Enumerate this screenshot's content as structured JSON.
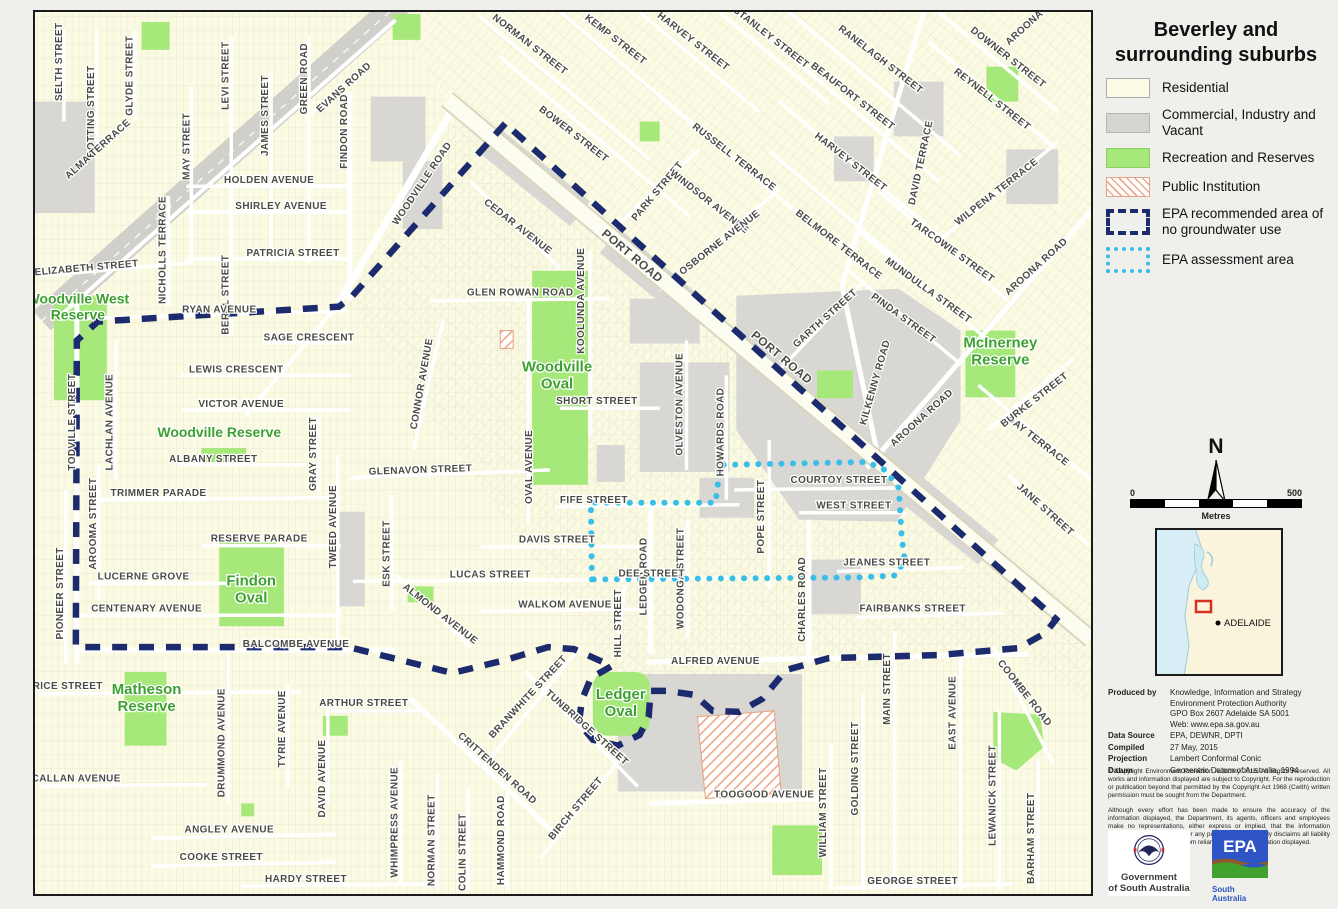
{
  "title": {
    "line1": "Beverley and",
    "line2": "surrounding suburbs"
  },
  "legend": {
    "items": [
      {
        "key": "residential",
        "label": "Residential"
      },
      {
        "key": "commercial",
        "label": "Commercial, Industry and Vacant"
      },
      {
        "key": "recreation",
        "label": "Recreation and Reserves"
      },
      {
        "key": "public",
        "label": "Public Institution"
      },
      {
        "key": "epa-recommended",
        "label": "EPA recommended area of no groundwater use"
      },
      {
        "key": "epa-assessment",
        "label": "EPA assessment area"
      }
    ]
  },
  "colors": {
    "residential": "#fcfbe3",
    "commercial": "#d6d5d1",
    "recreation": "#a7e87b",
    "public_hatch": "#eda98b",
    "epa_recommended": "#1b2b6e",
    "epa_assessment": "#38bfe8",
    "reserve_label": "#3da12f"
  },
  "compass": {
    "label": "N"
  },
  "scalebar": {
    "start": "0",
    "end": "500",
    "unit": "Metres"
  },
  "inset": {
    "city": "ADELAIDE"
  },
  "metadata": {
    "rows": [
      {
        "label": "Produced by",
        "lines": [
          "Knowledge, Information and Strategy",
          "Environment Protection Authority",
          "GPO Box 2607 Adelaide SA 5001",
          "Web: www.epa.sa.gov.au"
        ]
      },
      {
        "label": "Data Source",
        "lines": [
          "EPA, DEWNR, DPTI"
        ]
      },
      {
        "label": "Compiled",
        "lines": [
          "27 May, 2015"
        ]
      },
      {
        "label": "Projection",
        "lines": [
          "Lambert Conformal Conic"
        ]
      },
      {
        "label": "Datum",
        "lines": [
          "Geocentric Datum of Australia, 1994"
        ]
      }
    ]
  },
  "copyright": [
    "© Copyright Environment Protection Authority 2015. All Rights Reserved. All works and information displayed are subject to Copyright. For the reproduction or publication beyond that permitted by the Copyright Act 1968 (Cwlth) written permission must be sought from the Department.",
    "Although every effort has been made to ensure the accuracy of the information displayed, the Department, its agents, officers and employees make no representations, either express or implied, that the information displayed is accurate or fit for any purpose and expressly disclaims all liability for loss or damage arising from reliance upon the information displayed."
  ],
  "logos": {
    "gov": {
      "line1": "Government",
      "line2": "of South Australia"
    },
    "epa": {
      "acronym": "EPA",
      "region": "South Australia"
    }
  },
  "map": {
    "area_labels": [
      {
        "lines": [
          "Woodville West",
          "Reserve"
        ],
        "x": 76,
        "y": 303,
        "s": 14
      },
      {
        "lines": [
          "Woodville Reserve"
        ],
        "x": 218,
        "y": 437,
        "s": 14
      },
      {
        "lines": [
          "Woodville",
          "Oval"
        ],
        "x": 557,
        "y": 371,
        "s": 15
      },
      {
        "lines": [
          "Findon",
          "Oval"
        ],
        "x": 250,
        "y": 586,
        "s": 15
      },
      {
        "lines": [
          "Matheson",
          "Reserve"
        ],
        "x": 145,
        "y": 695,
        "s": 15
      },
      {
        "lines": [
          "Ledger",
          "Oval"
        ],
        "x": 621,
        "y": 700,
        "s": 15
      },
      {
        "lines": [
          "McInerney",
          "Reserve"
        ],
        "x": 1002,
        "y": 347,
        "s": 15
      }
    ],
    "street_labels": [
      {
        "t": "SELTH  STREET",
        "x": 60,
        "y": 60,
        "r": -90
      },
      {
        "t": "BOTTING  STREET",
        "x": 92,
        "y": 110,
        "r": -90
      },
      {
        "t": "GLYDE  STREET",
        "x": 131,
        "y": 74,
        "r": -90
      },
      {
        "t": "MAY  STREET",
        "x": 188,
        "y": 145,
        "r": -90
      },
      {
        "t": "LEVI  STREET",
        "x": 227,
        "y": 74,
        "r": -90
      },
      {
        "t": "JAMES  STREET",
        "x": 267,
        "y": 114,
        "r": -90
      },
      {
        "t": "GREEN  ROAD",
        "x": 306,
        "y": 77,
        "r": -90
      },
      {
        "t": "FINDON  ROAD",
        "x": 346,
        "y": 130,
        "r": -90
      },
      {
        "t": "BERYL  STREET",
        "x": 227,
        "y": 294,
        "r": -90
      },
      {
        "t": "NICHOLLS  TERRACE",
        "x": 164,
        "y": 249,
        "r": -90
      },
      {
        "t": "TODVILLE  STREET",
        "x": 73,
        "y": 422,
        "r": -90
      },
      {
        "t": "LACHLAN  AVENUE",
        "x": 111,
        "y": 422,
        "r": -90
      },
      {
        "t": "AROOMA  STREET",
        "x": 94,
        "y": 524,
        "r": -90
      },
      {
        "t": "PIONEER  STREET",
        "x": 61,
        "y": 594,
        "r": -90
      },
      {
        "t": "BEATRICE  AVENUE",
        "x": 27,
        "y": 594,
        "r": -90
      },
      {
        "t": "GRAY  STREET",
        "x": 315,
        "y": 454,
        "r": -90
      },
      {
        "t": "TWEED  AVENUE",
        "x": 335,
        "y": 527,
        "r": -90
      },
      {
        "t": "ESK  STREET",
        "x": 389,
        "y": 554,
        "r": -90
      },
      {
        "t": "CONNOR  AVENUE",
        "x": 424,
        "y": 384,
        "r": -80
      },
      {
        "t": "OVAL  AVENUE",
        "x": 532,
        "y": 467,
        "r": -90
      },
      {
        "t": "KOOLUNDA  AVENUE",
        "x": 584,
        "y": 300,
        "r": -90
      },
      {
        "t": "OLVESTON  AVENUE",
        "x": 683,
        "y": 404,
        "r": -90
      },
      {
        "t": "HOWARDS  ROAD",
        "x": 724,
        "y": 432,
        "r": -90
      },
      {
        "t": "POPE  STREET",
        "x": 765,
        "y": 517,
        "r": -90
      },
      {
        "t": "LEDGER  ROAD",
        "x": 647,
        "y": 577,
        "r": -90
      },
      {
        "t": "WODONGA  STREET",
        "x": 684,
        "y": 579,
        "r": -90
      },
      {
        "t": "CHARLES  ROAD",
        "x": 806,
        "y": 600,
        "r": -90
      },
      {
        "t": "HILL  STREET",
        "x": 621,
        "y": 624,
        "r": -90
      },
      {
        "t": "DRUMMOND  AVENUE",
        "x": 223,
        "y": 744,
        "r": -90
      },
      {
        "t": "TYRIE  AVENUE",
        "x": 284,
        "y": 730,
        "r": -90
      },
      {
        "t": "DAVID  AVENUE",
        "x": 324,
        "y": 780,
        "r": -90
      },
      {
        "t": "WHIMPRESS  AVENUE",
        "x": 397,
        "y": 824,
        "r": -90
      },
      {
        "t": "NORMAN  STREET",
        "x": 434,
        "y": 842,
        "r": -90
      },
      {
        "t": "COLIN  STREET",
        "x": 465,
        "y": 854,
        "r": -90
      },
      {
        "t": "HAMMOND  ROAD",
        "x": 504,
        "y": 842,
        "r": -90
      },
      {
        "t": "WILLIAM  STREET",
        "x": 827,
        "y": 814,
        "r": -90
      },
      {
        "t": "GOLDING  STREET",
        "x": 859,
        "y": 770,
        "r": -90
      },
      {
        "t": "MAIN  STREET",
        "x": 891,
        "y": 690,
        "r": -90
      },
      {
        "t": "EAST  AVENUE",
        "x": 957,
        "y": 714,
        "r": -90
      },
      {
        "t": "LEWANICK  STREET",
        "x": 997,
        "y": 797,
        "r": -90
      },
      {
        "t": "BARHAM  STREET",
        "x": 1036,
        "y": 840,
        "r": -90
      },
      {
        "t": "HOLDEN  AVENUE",
        "x": 268,
        "y": 182,
        "r": 0
      },
      {
        "t": "SHIRLEY  AVENUE",
        "x": 280,
        "y": 208,
        "r": 0
      },
      {
        "t": "PATRICIA  STREET",
        "x": 292,
        "y": 255,
        "r": 0
      },
      {
        "t": "ELIZABETH  STREET",
        "x": 85,
        "y": 270,
        "r": -5
      },
      {
        "t": "RYAN  AVENUE",
        "x": 218,
        "y": 312,
        "r": 0
      },
      {
        "t": "SAGE  CRESCENT",
        "x": 308,
        "y": 340,
        "r": 0
      },
      {
        "t": "LEWIS  CRESCENT",
        "x": 235,
        "y": 372,
        "r": 0
      },
      {
        "t": "VICTOR  AVENUE",
        "x": 240,
        "y": 407,
        "r": 0
      },
      {
        "t": "ALBANY  STREET",
        "x": 212,
        "y": 462,
        "r": 0
      },
      {
        "t": "TRIMMER  PARADE",
        "x": 157,
        "y": 496,
        "r": 0
      },
      {
        "t": "RESERVE  PARADE",
        "x": 258,
        "y": 542,
        "r": 0
      },
      {
        "t": "LUCERNE  GROVE",
        "x": 142,
        "y": 580,
        "r": 0
      },
      {
        "t": "CENTENARY  AVENUE",
        "x": 145,
        "y": 612,
        "r": 0
      },
      {
        "t": "BALCOMBE  AVENUE",
        "x": 295,
        "y": 648,
        "r": 0
      },
      {
        "t": "GLENAVON  STREET",
        "x": 420,
        "y": 473,
        "r": -2
      },
      {
        "t": "GLEN ROWAN  ROAD",
        "x": 520,
        "y": 295,
        "r": 0
      },
      {
        "t": "SHORT  STREET",
        "x": 597,
        "y": 404,
        "r": 0
      },
      {
        "t": "FIFE  STREET",
        "x": 594,
        "y": 503,
        "r": 0
      },
      {
        "t": "DAVIS  STREET",
        "x": 557,
        "y": 543,
        "r": 0
      },
      {
        "t": "LUCAS  STREET",
        "x": 490,
        "y": 578,
        "r": 0
      },
      {
        "t": "DEE  STREET",
        "x": 652,
        "y": 577,
        "r": 0
      },
      {
        "t": "WALKOM  AVENUE",
        "x": 565,
        "y": 608,
        "r": 0
      },
      {
        "t": "COURTOY  STREET",
        "x": 840,
        "y": 483,
        "r": 0
      },
      {
        "t": "WEST  STREET",
        "x": 855,
        "y": 509,
        "r": 0
      },
      {
        "t": "JEANES  STREET",
        "x": 888,
        "y": 566,
        "r": 0
      },
      {
        "t": "FAIRBANKS  STREET",
        "x": 914,
        "y": 612,
        "r": 0
      },
      {
        "t": "ALFRED  AVENUE",
        "x": 716,
        "y": 665,
        "r": 0
      },
      {
        "t": "TOOGOOD  AVENUE",
        "x": 765,
        "y": 799,
        "r": 0
      },
      {
        "t": "GEORGE  STREET",
        "x": 914,
        "y": 886,
        "r": 0
      },
      {
        "t": "BRICE  STREET",
        "x": 62,
        "y": 690,
        "r": 0
      },
      {
        "t": "MCALLAN  AVENUE",
        "x": 70,
        "y": 783,
        "r": 0
      },
      {
        "t": "ANGLEY  AVENUE",
        "x": 228,
        "y": 834,
        "r": 0
      },
      {
        "t": "COOKE  STREET",
        "x": 220,
        "y": 862,
        "r": 0
      },
      {
        "t": "HARDY  STREET",
        "x": 305,
        "y": 884,
        "r": 0
      },
      {
        "t": "ARTHUR  STREET",
        "x": 363,
        "y": 707,
        "r": 0
      },
      {
        "t": "NORMAN  STREET",
        "x": 528,
        "y": 45,
        "r": 38
      },
      {
        "t": "KEMP  STREET",
        "x": 614,
        "y": 40,
        "r": 38
      },
      {
        "t": "HARVEY  STREET",
        "x": 692,
        "y": 42,
        "r": 38
      },
      {
        "t": "STANLEY  STREET",
        "x": 770,
        "y": 38,
        "r": 38
      },
      {
        "t": "RANELAGH  STREET",
        "x": 880,
        "y": 60,
        "r": 38
      },
      {
        "t": "BEAUFORT  STREET",
        "x": 852,
        "y": 97,
        "r": 38
      },
      {
        "t": "DOWNER  STREET",
        "x": 1008,
        "y": 58,
        "r": 38
      },
      {
        "t": "REYNELL  STREET",
        "x": 992,
        "y": 100,
        "r": 38
      },
      {
        "t": "HARVEY  STREET",
        "x": 850,
        "y": 163,
        "r": 38
      },
      {
        "t": "BOWER  STREET",
        "x": 572,
        "y": 135,
        "r": 38
      },
      {
        "t": "RUSSELL  TERRACE",
        "x": 733,
        "y": 158,
        "r": 38
      },
      {
        "t": "PARK  STREET",
        "x": 660,
        "y": 192,
        "r": -50
      },
      {
        "t": "WINDSOR  AVENUE",
        "x": 708,
        "y": 203,
        "r": 38
      },
      {
        "t": "OSBORNE  AVENUE",
        "x": 722,
        "y": 244,
        "r": -38
      },
      {
        "t": "CEDAR  AVENUE",
        "x": 516,
        "y": 228,
        "r": 38
      },
      {
        "t": "WOODVILLE  ROAD",
        "x": 424,
        "y": 184,
        "r": -56
      },
      {
        "t": "ALMA  TERRACE",
        "x": 98,
        "y": 150,
        "r": -42
      },
      {
        "t": "EVANS  ROAD",
        "x": 345,
        "y": 88,
        "r": -42
      },
      {
        "t": "PORT  ROAD",
        "x": 630,
        "y": 258,
        "r": 40,
        "s": 12
      },
      {
        "t": "PORT  ROAD",
        "x": 780,
        "y": 360,
        "r": 40,
        "s": 12
      },
      {
        "t": "BELMORE  TERRACE",
        "x": 838,
        "y": 246,
        "r": 38
      },
      {
        "t": "TARCOWIE  STREET",
        "x": 952,
        "y": 252,
        "r": 36
      },
      {
        "t": "MUNDULLA  STREET",
        "x": 928,
        "y": 292,
        "r": 36
      },
      {
        "t": "PINDA  STREET",
        "x": 903,
        "y": 320,
        "r": 36
      },
      {
        "t": "WILPENA  TERRACE",
        "x": 1000,
        "y": 193,
        "r": -38
      },
      {
        "t": "DAVID  TERRACE",
        "x": 925,
        "y": 162,
        "r": -78
      },
      {
        "t": "GARTH  STREET",
        "x": 828,
        "y": 320,
        "r": -42
      },
      {
        "t": "KILKENNY  ROAD",
        "x": 879,
        "y": 383,
        "r": -74
      },
      {
        "t": "AROONA  ROAD",
        "x": 925,
        "y": 420,
        "r": -42
      },
      {
        "t": "AROONA  ROAD",
        "x": 1040,
        "y": 268,
        "r": -42
      },
      {
        "t": "AROONA",
        "x": 1028,
        "y": 28,
        "r": -42
      },
      {
        "t": "DAY  TERRACE",
        "x": 1038,
        "y": 443,
        "r": 38
      },
      {
        "t": "BURKE  STREET",
        "x": 1038,
        "y": 402,
        "r": -38
      },
      {
        "t": "JANE  STREET",
        "x": 1045,
        "y": 512,
        "r": 42
      },
      {
        "t": "COOMBE  ROAD",
        "x": 1024,
        "y": 696,
        "r": 52
      },
      {
        "t": "CRITTENDEN  ROAD",
        "x": 495,
        "y": 772,
        "r": 42
      },
      {
        "t": "BRANWHITE  STREET",
        "x": 530,
        "y": 700,
        "r": -47
      },
      {
        "t": "TUNBRIDGE  STREET",
        "x": 585,
        "y": 731,
        "r": 42
      },
      {
        "t": "BIRCH  STREET",
        "x": 578,
        "y": 812,
        "r": -50
      },
      {
        "t": "ALMOND  AVENUE",
        "x": 438,
        "y": 617,
        "r": 38
      }
    ]
  }
}
